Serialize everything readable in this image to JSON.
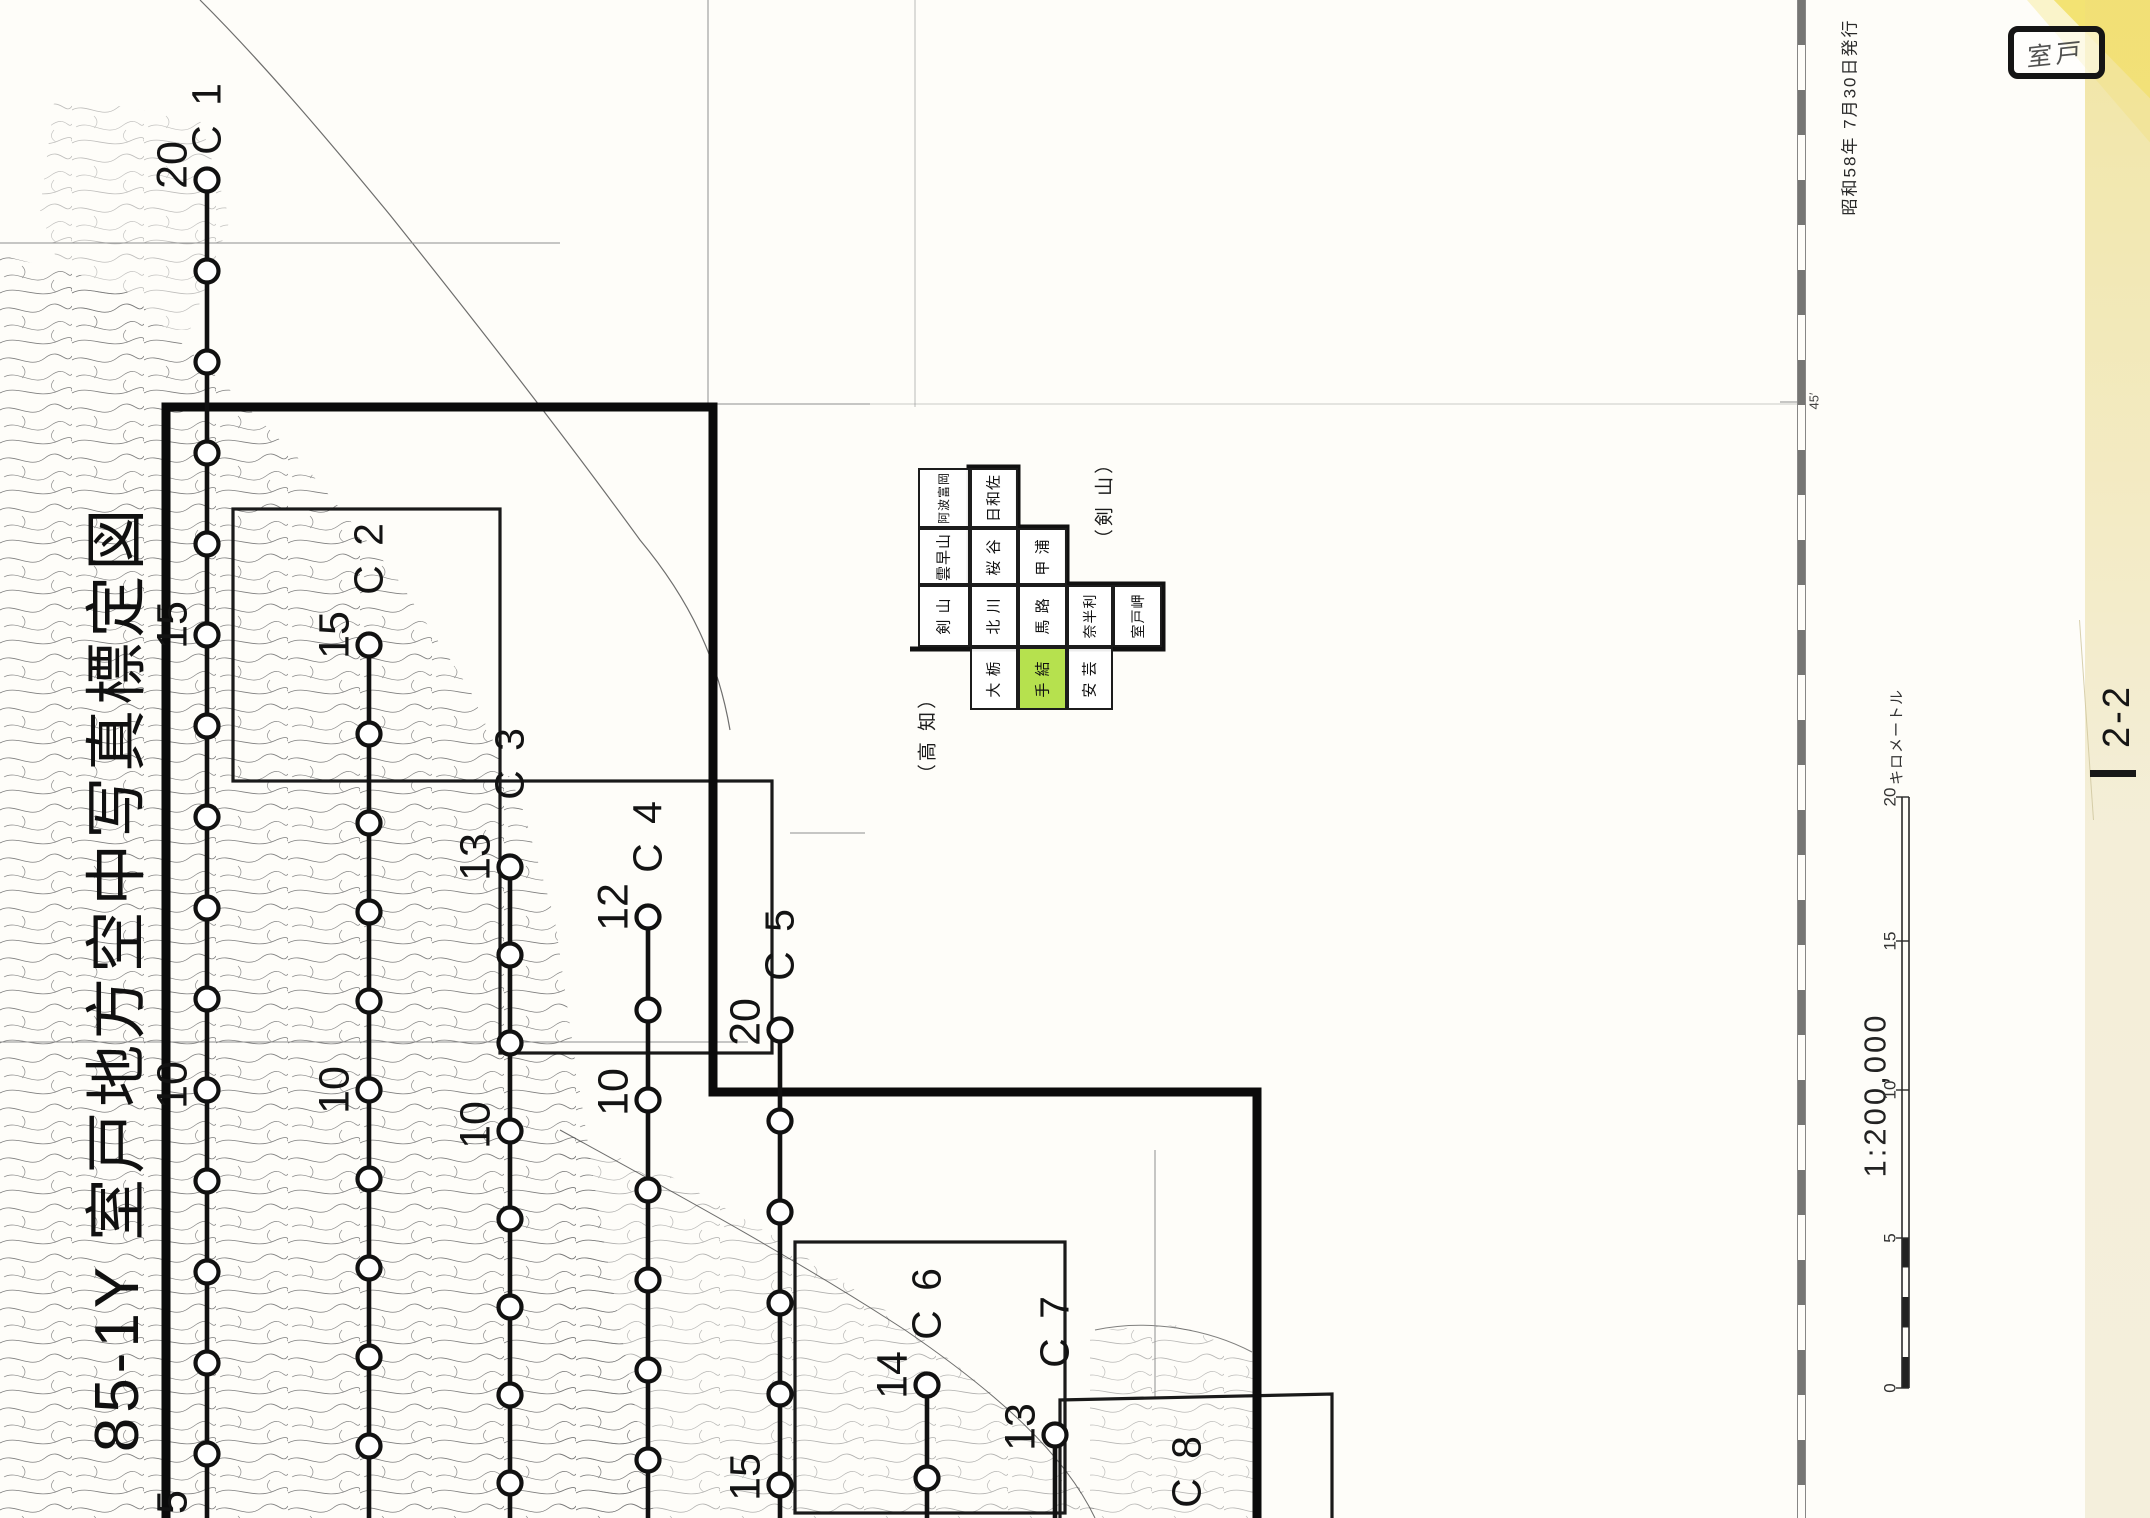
{
  "title": {
    "text": "85-1Y  室戸地方空中写真標定図"
  },
  "stamp": {
    "text": "室戸"
  },
  "publication": {
    "text": "昭和58年 7月30日発行"
  },
  "sheet_number": {
    "text": "2-2"
  },
  "border": {
    "latitude_tick": "45′"
  },
  "scale": {
    "ratio_text": "1:200,000",
    "bar_unit": "キロメートル",
    "ticks": [
      [
        "20",
        797
      ],
      [
        "15",
        941
      ],
      [
        "10",
        1090
      ],
      [
        "5",
        1238
      ],
      [
        "0",
        1388
      ]
    ]
  },
  "region_labels": {
    "left": "（高 知）",
    "right": "（剣 山）"
  },
  "index_grid": {
    "highlight_color": "#b6e14e",
    "highlighted_cell": "手 結",
    "cells": [
      {
        "label": "阿波富岡",
        "x": 918,
        "y": 468,
        "w": 52,
        "h": 60,
        "fs": 12,
        "hl": false
      },
      {
        "label": "雲早山",
        "x": 918,
        "y": 528,
        "w": 52,
        "h": 57,
        "fs": 15,
        "hl": false
      },
      {
        "label": "剣 山",
        "x": 918,
        "y": 585,
        "w": 52,
        "h": 62,
        "fs": 15,
        "hl": false
      },
      {
        "label": "日和佐",
        "x": 970,
        "y": 468,
        "w": 48,
        "h": 60,
        "fs": 15,
        "hl": false
      },
      {
        "label": "桜 谷",
        "x": 970,
        "y": 528,
        "w": 48,
        "h": 57,
        "fs": 15,
        "hl": false
      },
      {
        "label": "北 川",
        "x": 970,
        "y": 585,
        "w": 48,
        "h": 62,
        "fs": 15,
        "hl": false
      },
      {
        "label": "大 栃",
        "x": 970,
        "y": 647,
        "w": 48,
        "h": 63,
        "fs": 15,
        "hl": false
      },
      {
        "label": "甲 浦",
        "x": 1018,
        "y": 528,
        "w": 49,
        "h": 57,
        "fs": 15,
        "hl": false
      },
      {
        "label": "馬 路",
        "x": 1018,
        "y": 585,
        "w": 49,
        "h": 62,
        "fs": 15,
        "hl": false
      },
      {
        "label": "手 結",
        "x": 1018,
        "y": 647,
        "w": 49,
        "h": 63,
        "fs": 15,
        "hl": true
      },
      {
        "label": "奈半利",
        "x": 1067,
        "y": 585,
        "w": 46,
        "h": 62,
        "fs": 14,
        "hl": false
      },
      {
        "label": "安 芸",
        "x": 1067,
        "y": 647,
        "w": 46,
        "h": 63,
        "fs": 15,
        "hl": false
      },
      {
        "label": "室戸岬",
        "x": 1113,
        "y": 585,
        "w": 49,
        "h": 62,
        "fs": 14,
        "hl": false
      }
    ]
  },
  "flight_lines": [
    {
      "id": "C 1",
      "x": 207,
      "label_y": 117,
      "circles": [
        180,
        271,
        362,
        453,
        544,
        635,
        726,
        817,
        908,
        999,
        1090,
        1181,
        1272,
        1363,
        1454
      ],
      "numbers": [
        [
          "20",
          165
        ],
        [
          "15",
          625
        ],
        [
          "10",
          1085
        ],
        [
          "5",
          1502
        ]
      ]
    },
    {
      "id": "C 2",
      "x": 369,
      "label_y": 557,
      "circles": [
        645,
        734,
        823,
        912,
        1001,
        1090,
        1179,
        1268,
        1357,
        1446
      ],
      "numbers": [
        [
          "15",
          635
        ],
        [
          "10",
          1090
        ]
      ]
    },
    {
      "id": "C 3",
      "x": 510,
      "label_y": 762,
      "circles": [
        867,
        955,
        1043,
        1131,
        1219,
        1307,
        1395,
        1483
      ],
      "numbers": [
        [
          "13",
          857
        ],
        [
          "10",
          1125
        ]
      ]
    },
    {
      "id": "C 4",
      "x": 648,
      "label_y": 835,
      "circles": [
        917,
        1010,
        1100,
        1190,
        1280,
        1370,
        1460
      ],
      "numbers": [
        [
          "12",
          907
        ],
        [
          "10",
          1092
        ]
      ]
    },
    {
      "id": "C 5",
      "x": 780,
      "label_y": 943,
      "circles": [
        1030,
        1121,
        1212,
        1303,
        1394,
        1485
      ],
      "numbers": [
        [
          "20",
          1022
        ],
        [
          "15",
          1477
        ]
      ]
    },
    {
      "id": "C 6",
      "x": 927,
      "label_y": 1302,
      "circles": [
        1385,
        1478
      ],
      "numbers": [
        [
          "14",
          1375
        ]
      ]
    },
    {
      "id": "C 7",
      "x": 1055,
      "label_y": 1330,
      "circles": [
        1435
      ],
      "numbers": [
        [
          "13",
          1427
        ]
      ]
    },
    {
      "id": "C 8",
      "x": 1187,
      "label_y": 1470,
      "circles": [],
      "numbers": []
    }
  ]
}
